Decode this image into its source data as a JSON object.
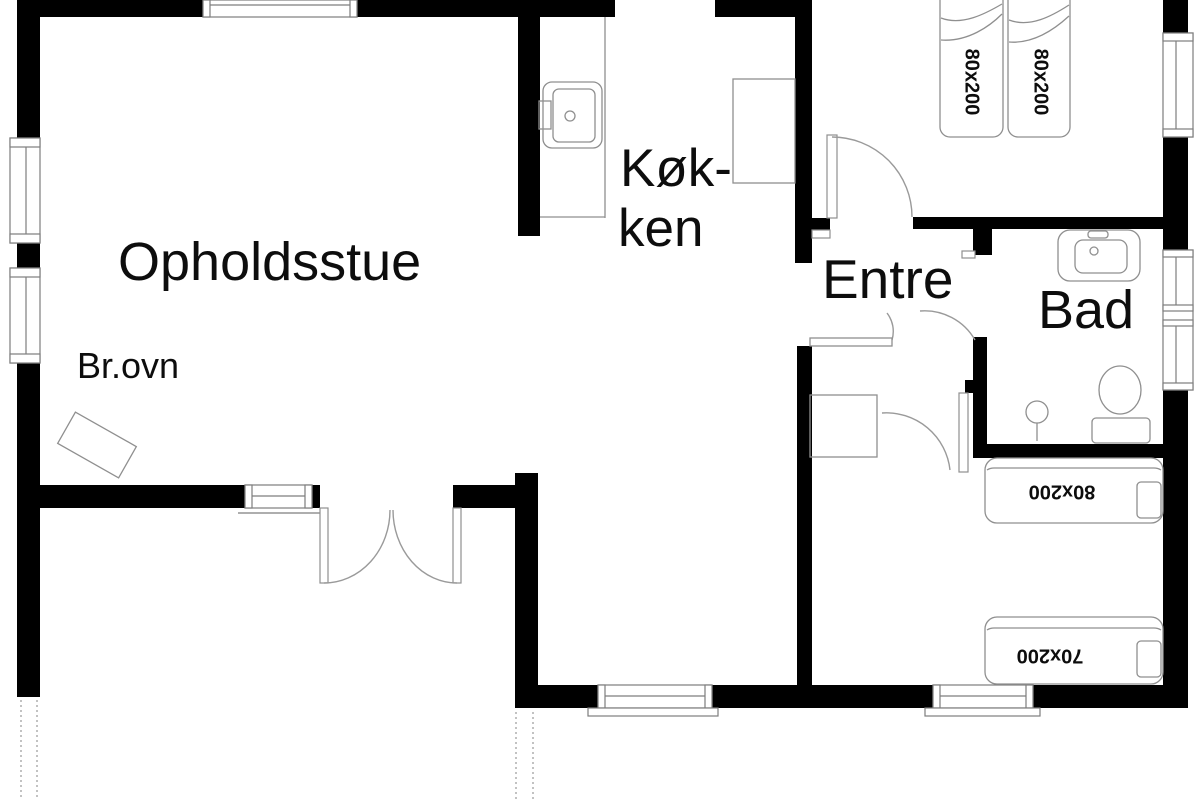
{
  "plan": {
    "colors": {
      "wall": "#000000",
      "thin_line": "#8f8f8f",
      "background": "#ffffff",
      "text": "#0d0d0d"
    },
    "rooms": {
      "living_room": "Opholdsstue",
      "kitchen_line1": "Køk-",
      "kitchen_line2": "ken",
      "entry": "Entre",
      "bathroom": "Bad",
      "stove_label": "Br.ovn"
    },
    "beds": {
      "bedroom1_left": "80x200",
      "bedroom1_right": "80x200",
      "bedroom2_top": "80x200",
      "bedroom2_bottom": "70x200"
    },
    "fixtures": [
      "kitchen-sink",
      "kitchen-counter",
      "refrigerator",
      "wood-stove",
      "bathroom-sink",
      "toilet",
      "floor-drain",
      "closet",
      "shelf"
    ]
  }
}
